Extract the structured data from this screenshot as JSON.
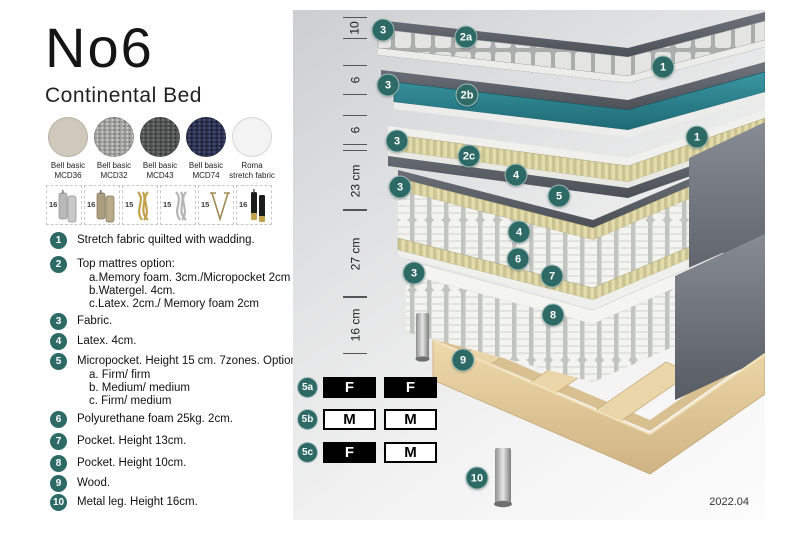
{
  "header": {
    "title": "No6",
    "subtitle": "Continental Bed"
  },
  "colors": {
    "accent_teal": "#2d6a66",
    "watergel_teal": "#2b7e8a",
    "option_black": "#000000"
  },
  "swatches": [
    {
      "line1": "Bell basic",
      "line2": "MCD36"
    },
    {
      "line1": "Bell basic",
      "line2": "MCD32"
    },
    {
      "line1": "Bell basic",
      "line2": "MCD43"
    },
    {
      "line1": "Bell basic",
      "line2": "MCD74"
    },
    {
      "line1": "Roma",
      "line2": "stretch fabric"
    }
  ],
  "legs": [
    {
      "count": "16",
      "type": "cylinder-silver-leg"
    },
    {
      "count": "16",
      "type": "cylinder-bronze-leg"
    },
    {
      "count": "15",
      "type": "twisted-gold-leg"
    },
    {
      "count": "15",
      "type": "twisted-silver-leg"
    },
    {
      "count": "15",
      "type": "hairpin-leg"
    },
    {
      "count": "16",
      "type": "black-gold-leg"
    }
  ],
  "legend": {
    "items": [
      {
        "num": "1",
        "text": "Stretch fabric quilted with wadding."
      },
      {
        "num": "2",
        "text": "Top mattres option:",
        "sub": [
          "a.Memory foam. 3cm./Micropocket 2cm",
          "b.Watergel. 4cm.",
          "c.Latex. 2cm./ Memory foam 2cm"
        ]
      },
      {
        "num": "3",
        "text": "Fabric."
      },
      {
        "num": "4",
        "text": "Latex. 4cm."
      },
      {
        "num": "5",
        "text": "Micropocket. Height 15 cm. 7zones. Option:",
        "sub": [
          "a. Firm/ firm",
          "b. Medium/ medium",
          "c. Firm/ medium"
        ]
      },
      {
        "num": "6",
        "text": "Polyurethane foam 25kg. 2cm."
      },
      {
        "num": "7",
        "text": "Pocket. Height 13cm."
      },
      {
        "num": "8",
        "text": "Pocket. Height 10cm."
      },
      {
        "num": "9",
        "text": "Wood."
      },
      {
        "num": "10",
        "text": "Metal leg. Height 16cm."
      }
    ]
  },
  "diagram": {
    "measurements": [
      {
        "label": "10"
      },
      {
        "label": "6"
      },
      {
        "label": "6"
      },
      {
        "label": "23 cm"
      },
      {
        "label": "27 cm"
      },
      {
        "label": "16 cm"
      }
    ],
    "callouts": [
      {
        "label": "3"
      },
      {
        "label": "2a"
      },
      {
        "label": "1"
      },
      {
        "label": "3"
      },
      {
        "label": "2b"
      },
      {
        "label": "1"
      },
      {
        "label": "3"
      },
      {
        "label": "2c"
      },
      {
        "label": "4"
      },
      {
        "label": "5"
      },
      {
        "label": "4"
      },
      {
        "label": "3"
      },
      {
        "label": "6"
      },
      {
        "label": "7"
      },
      {
        "label": "3"
      },
      {
        "label": "8"
      },
      {
        "label": "9"
      },
      {
        "label": "10"
      }
    ],
    "options": {
      "rows": [
        {
          "label": "5a",
          "cells": [
            "F",
            "F"
          ]
        },
        {
          "label": "5b",
          "cells": [
            "M",
            "M"
          ]
        },
        {
          "label": "5c",
          "cells": [
            "F",
            "M"
          ]
        }
      ]
    },
    "version": "2022.04"
  }
}
